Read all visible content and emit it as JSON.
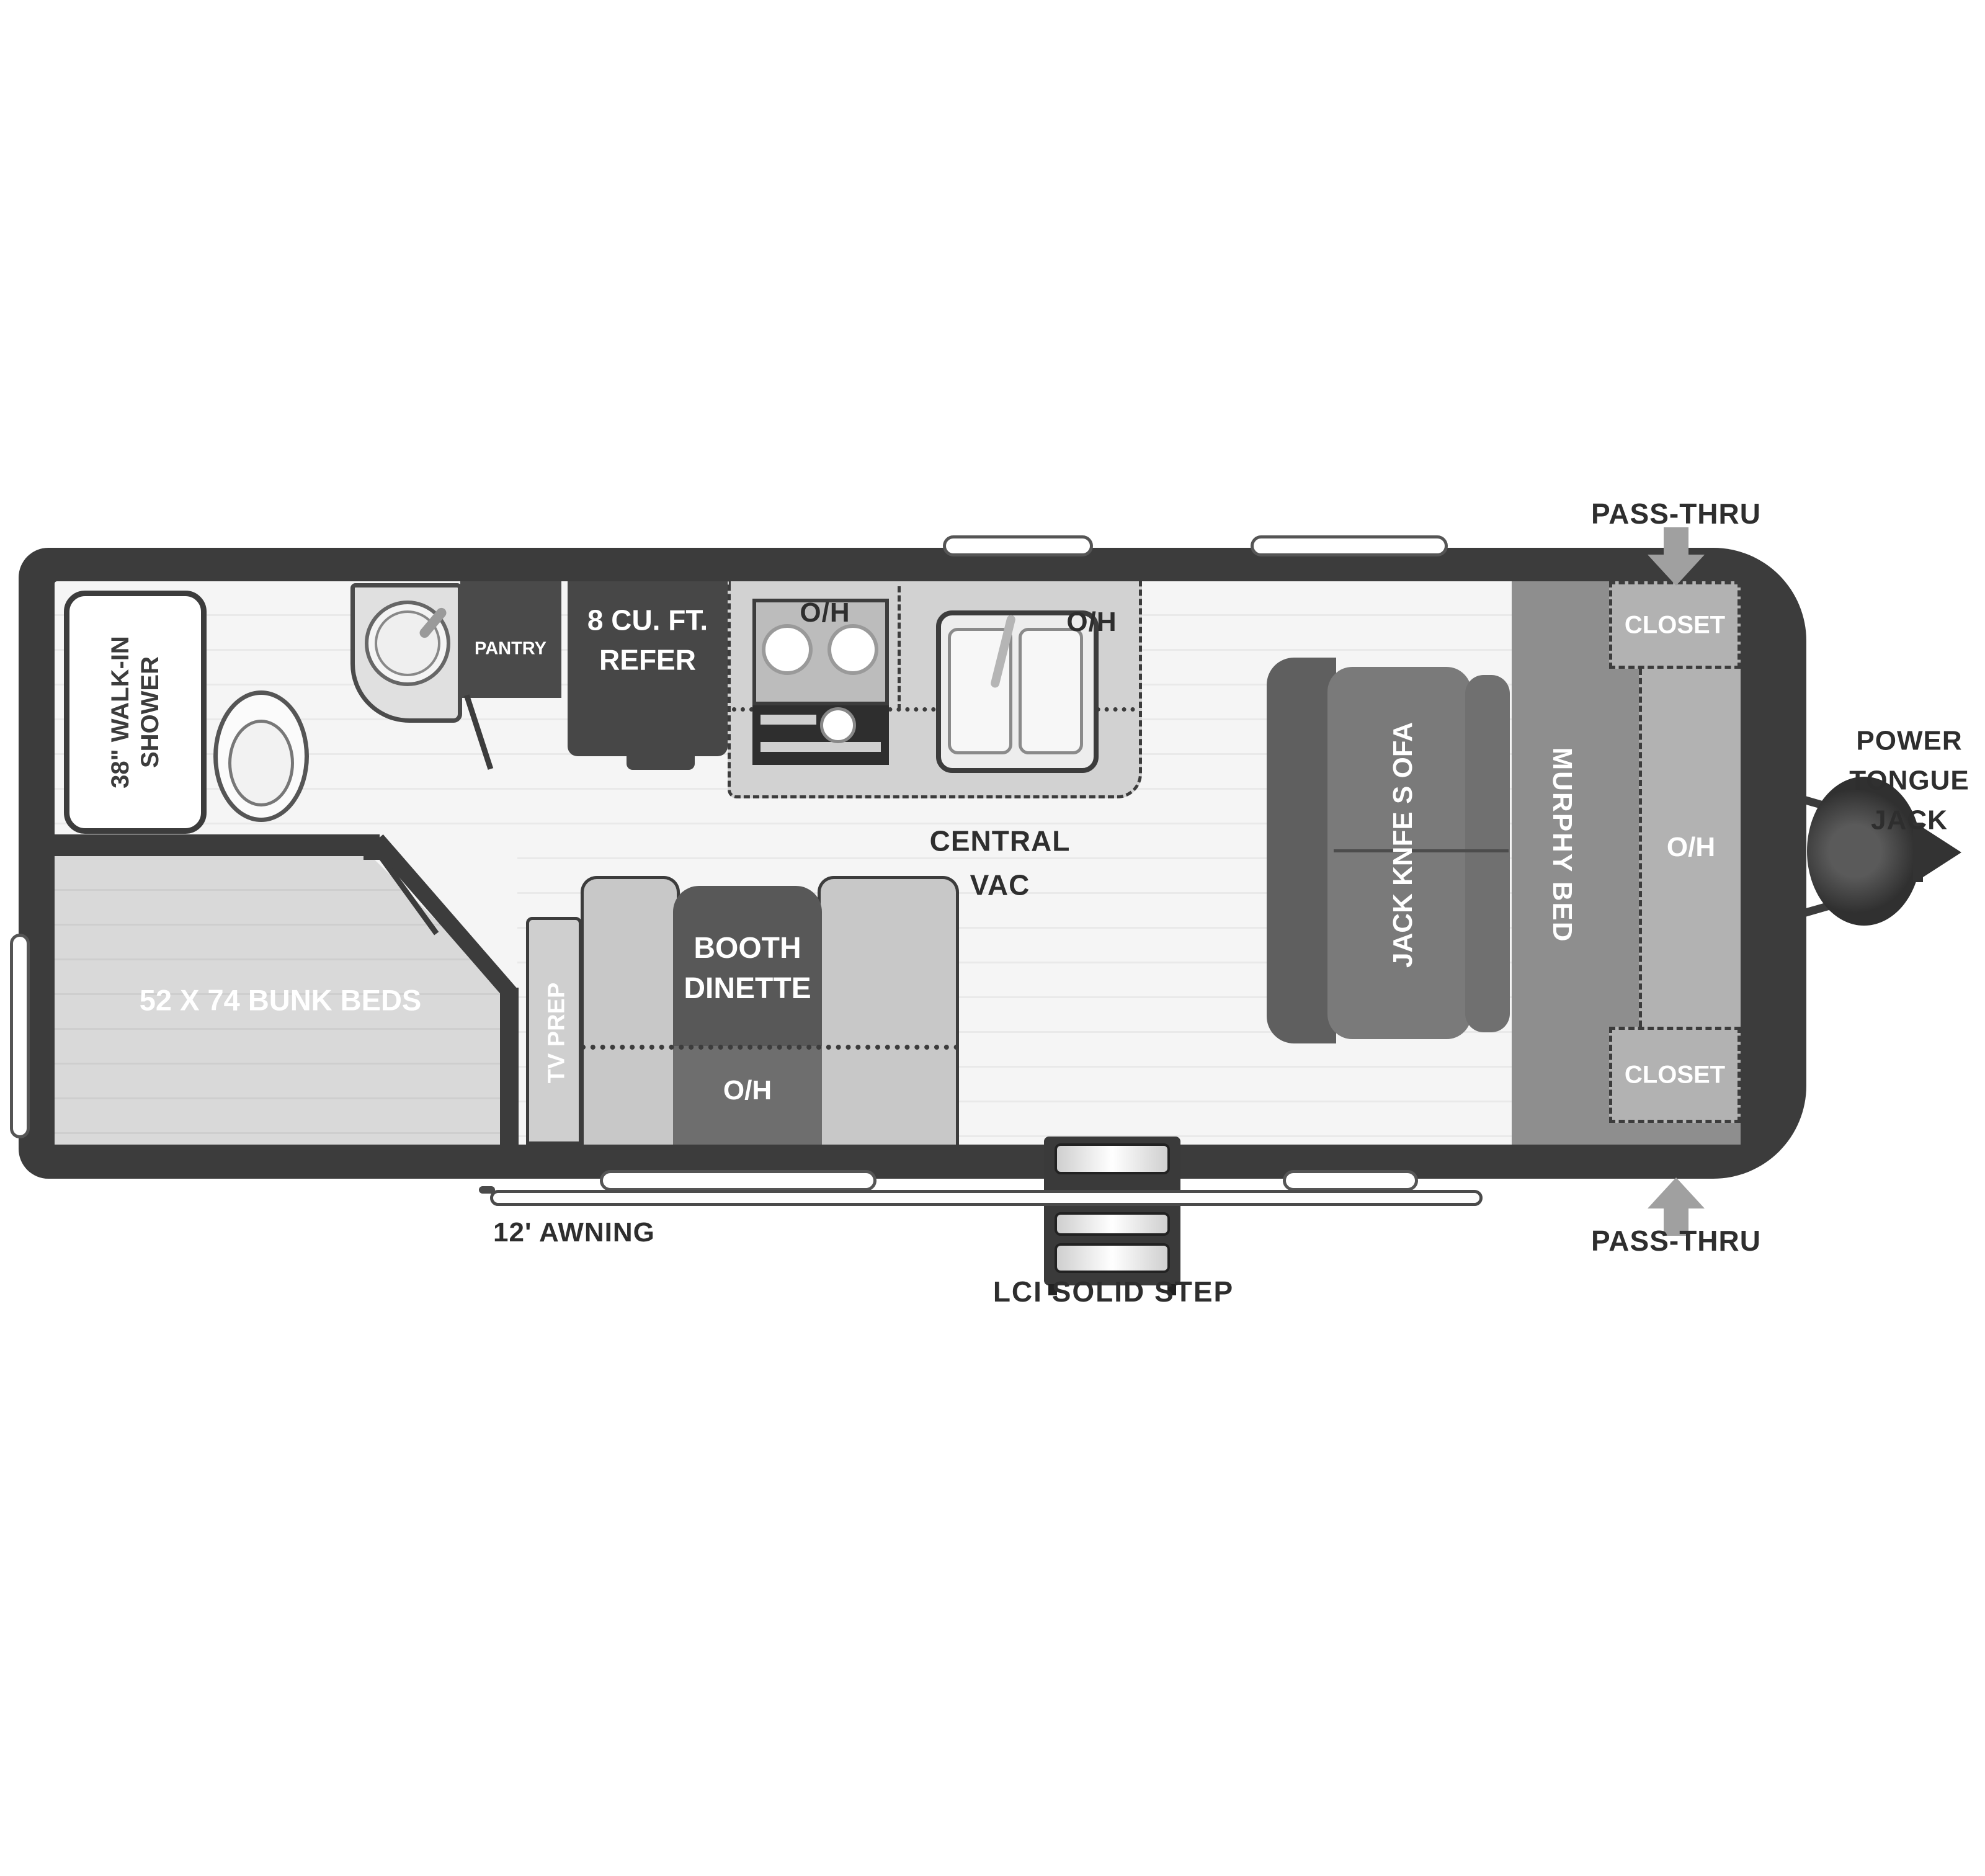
{
  "diagram": {
    "type": "rv-travel-trailer-floorplan",
    "colors": {
      "wall": "#3c3c3c",
      "floor": "#f5f5f5",
      "dark_cabinet": "#474747",
      "furniture_gray": "#8e8e8e",
      "overhead_gray": "#b2b2b2",
      "label_dark": "#2e2e2e",
      "label_white": "#ffffff",
      "arrow_gray": "#a0a0a0"
    },
    "bathroom": {
      "shower_line1": "38\" WALK-IN",
      "shower_line2": "SHOWER",
      "pantry": "PANTRY"
    },
    "kitchen": {
      "refer_line1": "8 CU. FT.",
      "refer_line2": "REFER",
      "oh": "O/H",
      "central_vac_line1": "CENTRAL",
      "central_vac_line2": "VAC"
    },
    "dinette": {
      "tv_prep": "TV PREP",
      "booth_line1": "BOOTH",
      "booth_line2": "DINETTE",
      "oh": "O/H"
    },
    "bunk_room": {
      "label": "52 X 74 BUNK BEDS"
    },
    "front_bedroom": {
      "murphy_bed": "MURPHY BED",
      "sofa": "JACK KNFE S OFA",
      "closet_top": "CLOSET",
      "closet_bottom": "CLOSET",
      "oh": "O/H"
    },
    "exterior": {
      "pass_thru_top": "PASS-THRU",
      "pass_thru_bottom": "PASS-THRU",
      "power_tongue_jack_line1": "POWER",
      "power_tongue_jack_line2": "TONGUE",
      "power_tongue_jack_line3": "JACK",
      "awning": "12' AWNING",
      "step": "LCI SOLID STEP"
    }
  }
}
